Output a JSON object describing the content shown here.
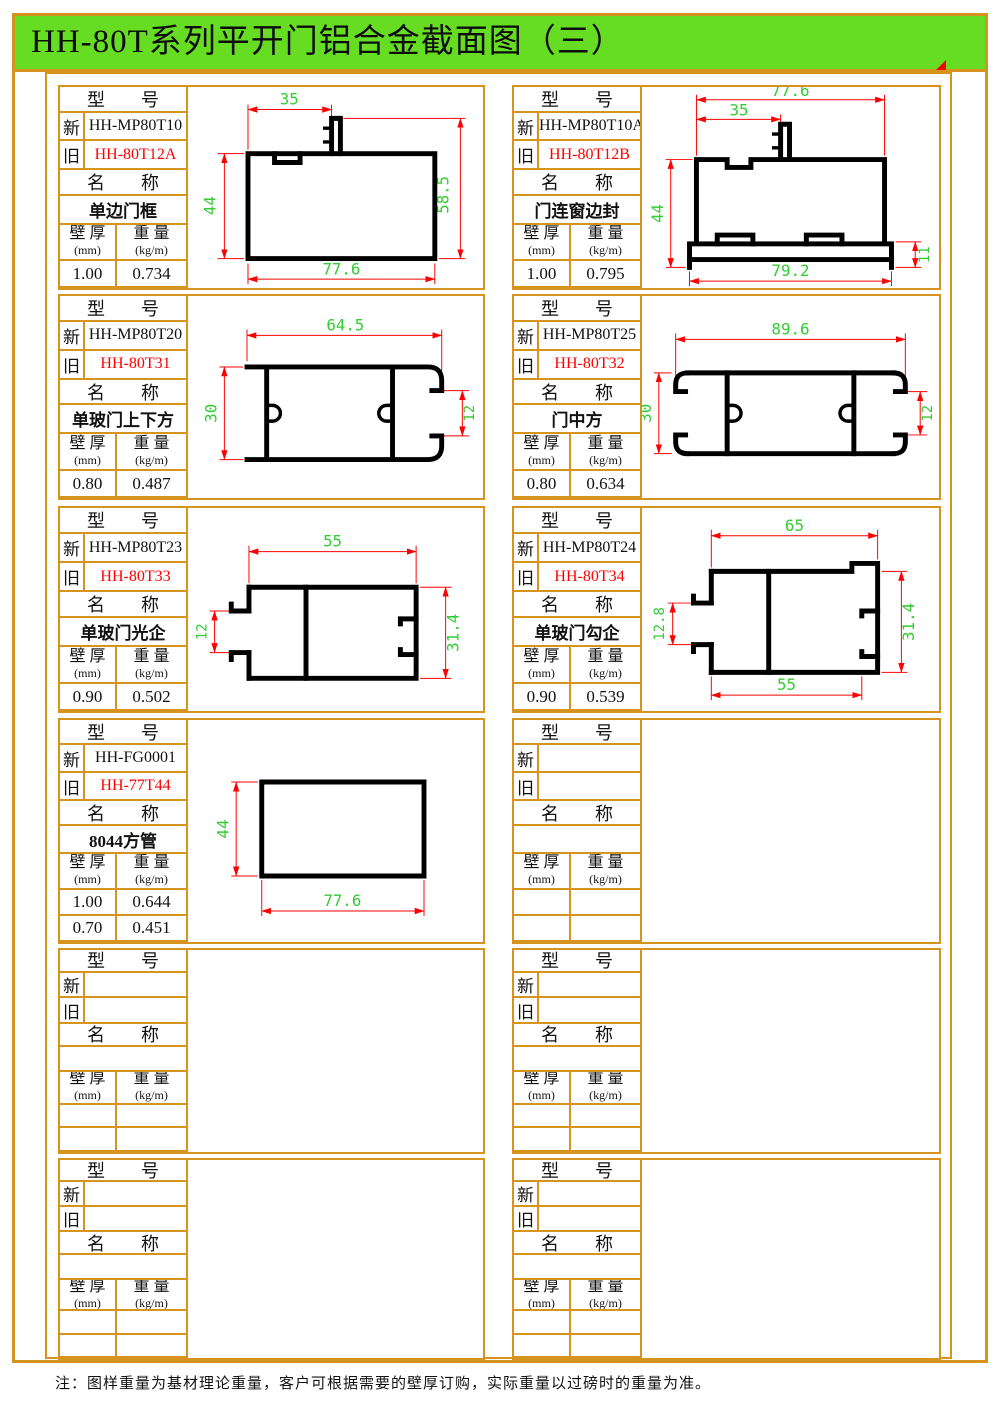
{
  "title": "HH-80T系列平开门铝合金截面图（三）",
  "note": "注：图样重量为基材理论重量，客户可根据需要的壁厚订购，实际重量以过磅时的重量为准。",
  "colors": {
    "frame": "#d6931d",
    "title_bg": "#66dd22",
    "old_red": "#ff0000",
    "dim_red": "#ff0000",
    "dim_green": "#33cc33",
    "profile": "#000000"
  },
  "labels": {
    "model_header": "型　　号",
    "new_tag": "新",
    "old_tag": "旧",
    "name_header": "名　　称",
    "wall_line1": "壁 厚",
    "wall_line2": "(mm)",
    "weight_line1": "重 量",
    "weight_line2": "(kg/m)"
  },
  "panels": [
    {
      "new": "HH-MP80T10",
      "old": "HH-80T12A",
      "name": "单边门框",
      "rows": [
        [
          "1.00",
          "0.734"
        ]
      ],
      "dims": {
        "top": "35",
        "left": "44",
        "right": "58.5",
        "bottom": "77.6"
      }
    },
    {
      "new": "HH-MP80T10A",
      "old": "HH-80T12B",
      "name": "门连窗边封",
      "rows": [
        [
          "1.00",
          "0.795"
        ]
      ],
      "dims": {
        "top": "77.6",
        "top2": "35",
        "left": "44",
        "bottom": "79.2",
        "right": "11"
      }
    },
    {
      "new": "HH-MP80T20",
      "old": "HH-80T31",
      "name": "单玻门上下方",
      "rows": [
        [
          "0.80",
          "0.487"
        ]
      ],
      "dims": {
        "top": "64.5",
        "left": "30",
        "right": "12"
      }
    },
    {
      "new": "HH-MP80T25",
      "old": "HH-80T32",
      "name": "门中方",
      "rows": [
        [
          "0.80",
          "0.634"
        ]
      ],
      "dims": {
        "top": "89.6",
        "left": "30",
        "right": "12"
      }
    },
    {
      "new": "HH-MP80T23",
      "old": "HH-80T33",
      "name": "单玻门光企",
      "rows": [
        [
          "0.90",
          "0.502"
        ]
      ],
      "dims": {
        "top": "55",
        "left": "12",
        "right": "31.4"
      }
    },
    {
      "new": "HH-MP80T24",
      "old": "HH-80T34",
      "name": "单玻门勾企",
      "rows": [
        [
          "0.90",
          "0.539"
        ]
      ],
      "dims": {
        "top": "65",
        "left": "12.8",
        "right": "31.4",
        "bottom": "55"
      }
    },
    {
      "new": "HH-FG0001",
      "old": "HH-77T44",
      "name": "8044方管",
      "rows": [
        [
          "1.00",
          "0.644"
        ],
        [
          "0.70",
          "0.451"
        ]
      ],
      "dims": {
        "left": "44",
        "bottom": "77.6"
      }
    },
    {
      "new": "",
      "old": "",
      "name": "",
      "rows": [
        [
          "",
          ""
        ],
        [
          "",
          ""
        ]
      ]
    },
    {
      "new": "",
      "old": "",
      "name": "",
      "rows": [
        [
          "",
          ""
        ],
        [
          "",
          ""
        ]
      ]
    },
    {
      "new": "",
      "old": "",
      "name": "",
      "rows": [
        [
          "",
          ""
        ],
        [
          "",
          ""
        ]
      ]
    },
    {
      "new": "",
      "old": "",
      "name": "",
      "rows": [
        [
          "",
          ""
        ],
        [
          "",
          ""
        ]
      ]
    },
    {
      "new": "",
      "old": "",
      "name": "",
      "rows": [
        [
          "",
          ""
        ],
        [
          "",
          ""
        ]
      ]
    }
  ]
}
